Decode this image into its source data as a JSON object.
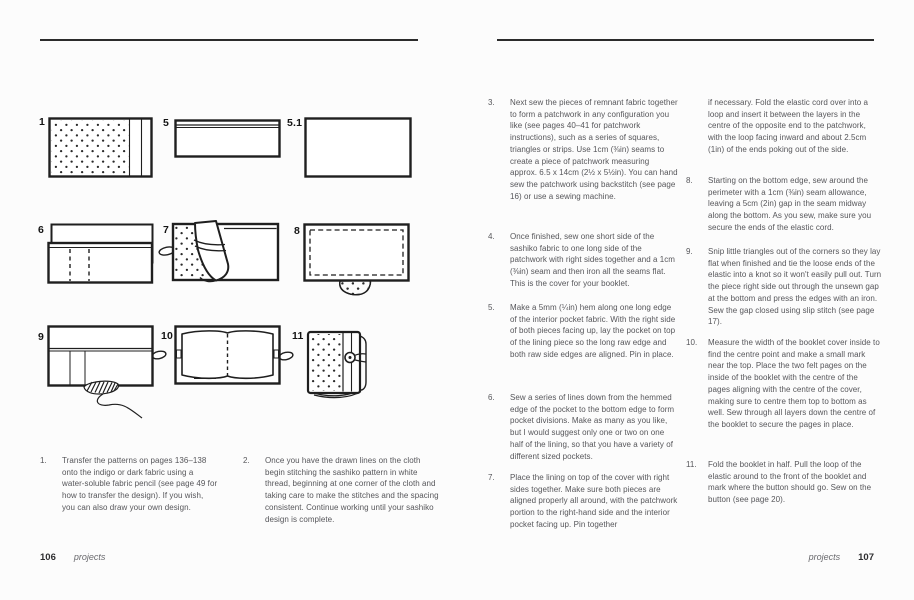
{
  "palette": {
    "ink": "#1f1f1f",
    "text_gray": "#56565a",
    "rule": "#2b2b2b",
    "background": "#fcfcfc"
  },
  "left_page": {
    "diagram_labels": [
      "1",
      "5",
      "5.1",
      "6",
      "7",
      "8",
      "9",
      "10",
      "11"
    ],
    "diagram_names": [
      "sashiko-fabric-panel",
      "hemmed-pocket",
      "lining-piece",
      "pocket-on-lining-divisions",
      "lining-folded-over-cover-with-elastic",
      "sewn-perimeter-with-gap",
      "slip-stitching-gap-closed",
      "felt-pages-centre-stitch",
      "finished-booklet-with-button"
    ],
    "steps": [
      {
        "num": "1.",
        "text": "Transfer the patterns on pages 136–138 onto the indigo or dark fabric using a water-soluble fabric pencil (see page 49 for how to transfer the design). If you wish, you can also draw your own design."
      },
      {
        "num": "2.",
        "text": "Once you have the drawn lines on the cloth begin stitching the sashiko pattern in white thread, beginning at one corner of the cloth and taking care to make the stitches and the spacing consistent. Continue working until your sashiko design is complete."
      }
    ],
    "footer": {
      "page_number": "106",
      "section_label": "projects"
    }
  },
  "right_page": {
    "column1_steps": [
      {
        "num": "3.",
        "text": "Next sew the pieces of remnant fabric together to form a patchwork in any configuration you like (see pages 40–41 for patchwork instructions), such as a series of squares, triangles or strips. Use 1cm (⅜in) seams to create a piece of patchwork measuring approx. 6.5 x 14cm (2½ x 5½in). You can hand sew the patchwork using backstitch (see page 16) or use a sewing machine."
      },
      {
        "num": "4.",
        "text": "Once finished, sew one short side of the sashiko fabric to one long side of the patchwork with right sides together and a 1cm (⅜in) seam and then iron all the seams flat. This is the cover for your booklet."
      },
      {
        "num": "5.",
        "text": "Make a 5mm (¼in) hem along one long edge of the interior pocket fabric. With the right side of both pieces facing up, lay the pocket on top of the lining piece so the long raw edge and both raw side edges are aligned. Pin in place."
      },
      {
        "num": "6.",
        "text": "Sew a series of lines down from the hemmed edge of the pocket to the bottom edge to form pocket divisions. Make as many as you like, but I would suggest only one or two on one half of the lining, so that you have a variety of different sized pockets."
      },
      {
        "num": "7.",
        "text": "Place the lining on top of the cover with right sides together. Make sure both pieces are aligned properly all around, with the patchwork portion to the right-hand side and the interior pocket facing up. Pin together"
      }
    ],
    "column2_steps": [
      {
        "num": "",
        "text": "if necessary. Fold the elastic cord over into a loop and insert it between the layers in the centre of the opposite end to the patchwork, with the loop facing inward and about 2.5cm (1in) of the ends poking out of the side."
      },
      {
        "num": "8.",
        "text": "Starting on the bottom edge, sew around the perimeter with a 1cm (⅜in) seam allowance, leaving a 5cm (2in) gap in the seam midway along the bottom. As you sew, make sure you secure the ends of the elastic cord."
      },
      {
        "num": "9.",
        "text": "Snip little triangles out of the corners so they lay flat when finished and tie the loose ends of the elastic into a knot so it won't easily pull out. Turn the piece right side out through the unsewn gap at the bottom and press the edges with an iron. Sew the gap closed using slip stitch (see page 17)."
      },
      {
        "num": "10.",
        "text": "Measure the width of the booklet cover inside to find the centre point and make a small mark near the top. Place the two felt pages on the inside of the booklet with the centre of the pages aligning with the centre of the cover, making sure to centre them top to bottom as well. Sew through all layers down the centre of the booklet to secure the pages in place."
      },
      {
        "num": "11.",
        "text": "Fold the booklet in half. Pull the loop of the elastic around to the front of the booklet and mark where the button should go. Sew on the button (see page 20)."
      }
    ],
    "footer": {
      "page_number": "107",
      "section_label": "projects"
    }
  }
}
